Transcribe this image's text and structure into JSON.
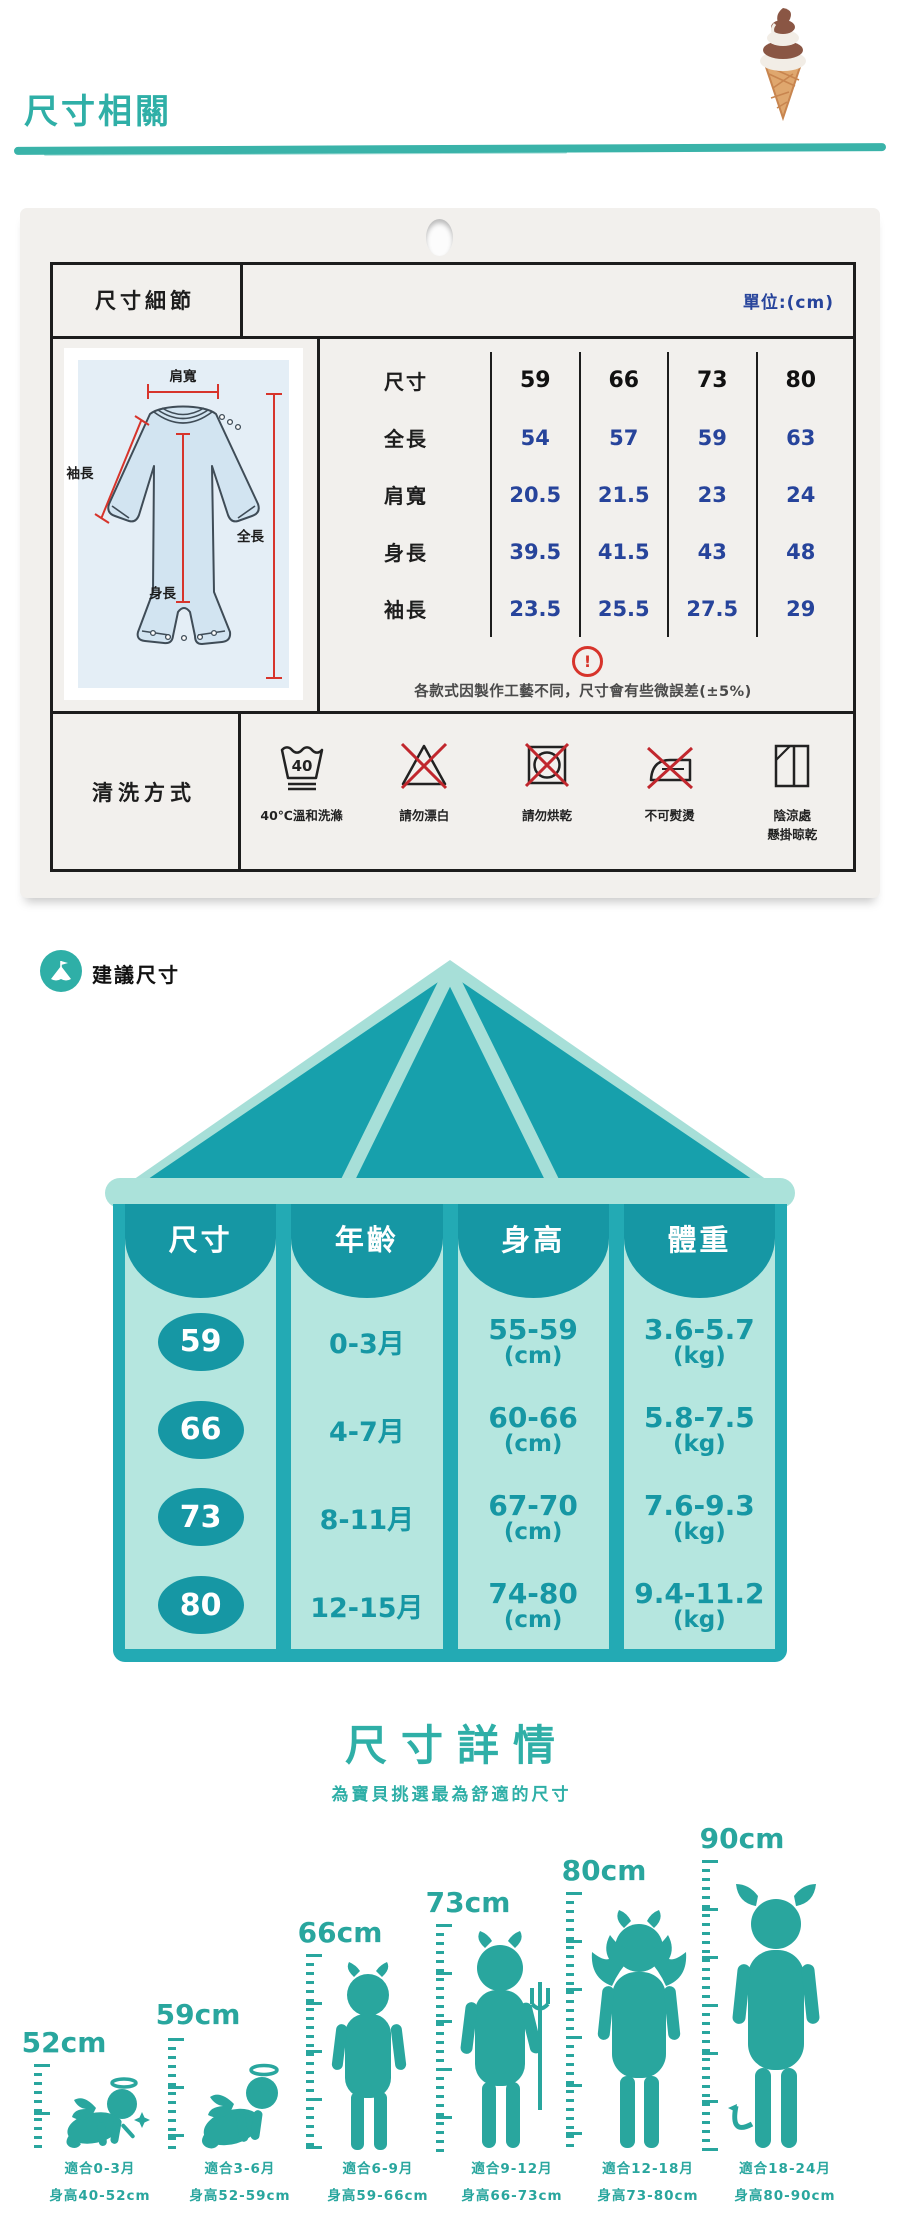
{
  "header": {
    "title": "尺寸相關"
  },
  "size_card": {
    "title": "尺寸細節",
    "unit": "單位:(cm)",
    "diagram": {
      "shoulder": "肩寬",
      "sleeve": "袖長",
      "body": "身長",
      "full": "全長"
    },
    "spec_table": {
      "rows": [
        {
          "label": "尺寸",
          "values": [
            "59",
            "66",
            "73",
            "80"
          ]
        },
        {
          "label": "全長",
          "values": [
            "54",
            "57",
            "59",
            "63"
          ]
        },
        {
          "label": "肩寬",
          "values": [
            "20.5",
            "21.5",
            "23",
            "24"
          ]
        },
        {
          "label": "身長",
          "values": [
            "39.5",
            "41.5",
            "43",
            "48"
          ]
        },
        {
          "label": "袖長",
          "values": [
            "23.5",
            "25.5",
            "27.5",
            "29"
          ]
        }
      ]
    },
    "note": "各款式因製作工藝不同，尺寸會有些微誤差(±5%)",
    "wash": {
      "title": "清洗方式",
      "items": [
        {
          "icon": "wash-40c-icon",
          "label": "40℃溫和洗滌"
        },
        {
          "icon": "no-bleach-icon",
          "label": "請勿漂白"
        },
        {
          "icon": "no-tumble-dry-icon",
          "label": "請勿烘乾"
        },
        {
          "icon": "no-iron-icon",
          "label": "不可熨燙"
        },
        {
          "icon": "hang-dry-in-shade-icon",
          "label_line1": "陰涼處",
          "label_line2": "懸掛晾乾"
        }
      ]
    }
  },
  "suggested": {
    "badge": "建議尺寸",
    "columns": [
      "尺寸",
      "年齡",
      "身高",
      "體重"
    ],
    "rows": [
      {
        "size": "59",
        "age": "0-3月",
        "height": "55-59",
        "height_unit": "(cm)",
        "weight": "3.6-5.7",
        "weight_unit": "(kg)"
      },
      {
        "size": "66",
        "age": "4-7月",
        "height": "60-66",
        "height_unit": "(cm)",
        "weight": "5.8-7.5",
        "weight_unit": "(kg)"
      },
      {
        "size": "73",
        "age": "8-11月",
        "height": "67-70",
        "height_unit": "(cm)",
        "weight": "7.6-9.3",
        "weight_unit": "(kg)"
      },
      {
        "size": "80",
        "age": "12-15月",
        "height": "74-80",
        "height_unit": "(cm)",
        "weight": "9.4-11.2",
        "weight_unit": "(kg)"
      }
    ]
  },
  "details": {
    "title": "尺寸詳情",
    "subtitle": "為寶貝挑選最為舒適的尺寸",
    "milestones": [
      {
        "height": "52cm",
        "fit": "適合0-3月",
        "range": "身高40-52cm"
      },
      {
        "height": "59cm",
        "fit": "適合3-6月",
        "range": "身高52-59cm"
      },
      {
        "height": "66cm",
        "fit": "適合6-9月",
        "range": "身高59-66cm"
      },
      {
        "height": "73cm",
        "fit": "適合9-12月",
        "range": "身高66-73cm"
      },
      {
        "height": "80cm",
        "fit": "適合12-18月",
        "range": "身高73-80cm"
      },
      {
        "height": "90cm",
        "fit": "適合18-24月",
        "range": "身高80-90cm"
      }
    ]
  },
  "colors": {
    "teal": "#2FAFA7",
    "deep_teal": "#1697A4",
    "tent_dark": "#17A0AC",
    "tent_light": "#A7DFD8",
    "tent_frame": "#23AAB4",
    "cell_mint": "#B5E6DF",
    "value_blue": "#27449B",
    "warn_red": "#D7342B",
    "silhouette_teal": "#29A69E"
  }
}
